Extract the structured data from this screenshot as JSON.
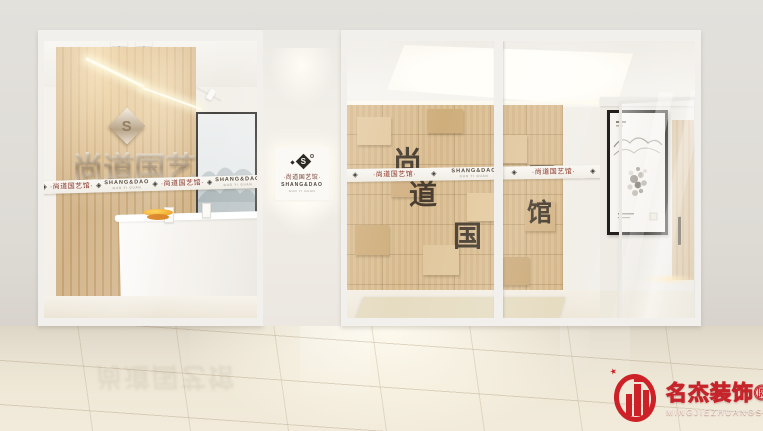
{
  "signage": {
    "lightbox": {
      "chinese": "·尚道国艺馆·",
      "brand": "SHANG&DAO",
      "sub": "GUO YI GUAN",
      "monogram": "S"
    },
    "left_wall_text": "尚道国艺馆",
    "right_wall_chars": [
      "尚",
      "道",
      "国",
      "馆"
    ]
  },
  "tape": {
    "diamond": "◈",
    "chinese": "·尚道国艺馆·",
    "brand": "SHANG&DAO",
    "sub": "GUO YI GUAN"
  },
  "watermark": {
    "name": "名杰装饰®",
    "latin": "MINGJIEZHUANGSHI",
    "star": "★"
  },
  "colors": {
    "brand_red": "#cd2127",
    "tape_text_red": "#8a3326",
    "wood_slat": "#cdb084",
    "wood_tile": "#d9bd93",
    "wall_char_dark": "#473c2f",
    "wall_grey": "#dedbd5",
    "floor_cream": "#e9e2d2"
  }
}
